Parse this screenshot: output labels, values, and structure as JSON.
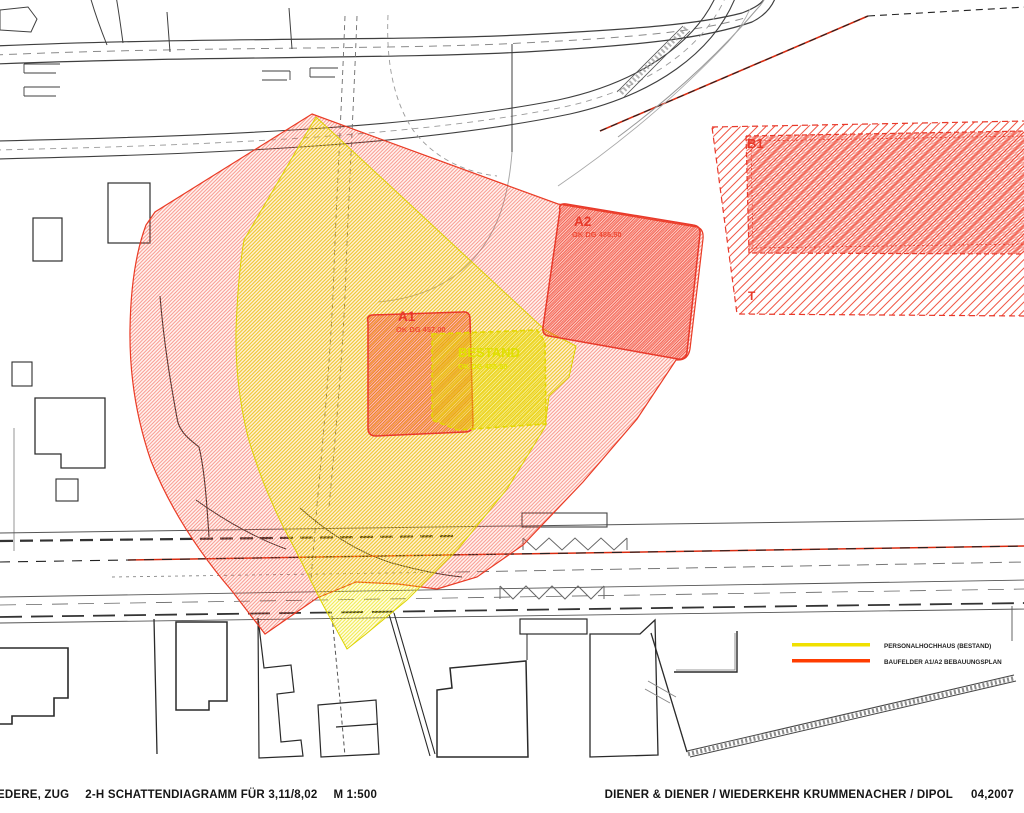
{
  "colors": {
    "shadow_red": "#ee3a26",
    "shadow_yellow": "#eede00",
    "legend_yellow": "#f0e000",
    "legend_red": "#ff3c00",
    "linework": "#3a3a3a"
  },
  "labels": {
    "a1": {
      "name": "A1",
      "elevation": "OK DG 457,00"
    },
    "a2": {
      "name": "A2",
      "elevation": "OK DG 486,50"
    },
    "bestand": {
      "name": "BESTAND",
      "elevation": "OK DG 455,50"
    },
    "b1": "B1",
    "t": "T"
  },
  "legend": {
    "items": [
      {
        "label": "PERSONALHOCHHAUS (BESTAND)",
        "color": "#f0e000"
      },
      {
        "label": "BAUFELDER A1/A2 BEBAUUNGSPLAN",
        "color": "#ff3c00"
      }
    ]
  },
  "title_block": {
    "project": "EDERE, ZUG",
    "subtitle": "2-H SCHATTENDIAGRAMM FÜR 3,11/8,02",
    "scale": "M 1:500",
    "architects": "DIENER & DIENER / WIEDERKEHR KRUMMENACHER / DIPOL",
    "date": "04,2007"
  }
}
